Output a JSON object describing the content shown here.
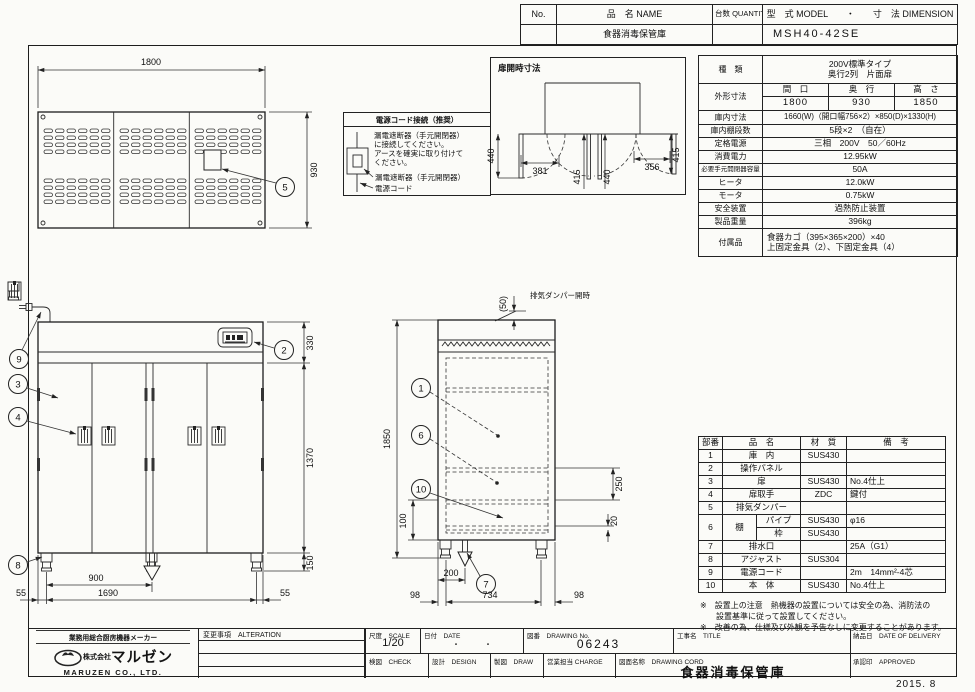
{
  "top_table": {
    "no_label": "No.",
    "name_label": "品　名 NAME",
    "qty_label": "台数 QUANTITY",
    "model_label": "型　式 MODEL　　・　　寸　法 DIMENSION",
    "product_name": "食器消毒保管庫",
    "model_value": "MSH40-42SE"
  },
  "spec": {
    "kind_label": "種　類",
    "kind1": "200V標準タイプ",
    "kind2": "奥行2列　片面扉",
    "outer_label": "外形寸法",
    "w_label": "間　口",
    "d_label": "奥　行",
    "h_label": "高　さ",
    "w_val": "1800",
    "d_val": "930",
    "h_val": "1850",
    "inner_label": "庫内寸法",
    "inner_val": "1660(W)（開口幅756×2）×850(D)×1330(H)",
    "shelf_label": "庫内棚段数",
    "shelf_val": "5段×2　（自在）",
    "power_label": "定格電源",
    "power_val": "三相　200V　50／60Hz",
    "cons_label": "消費電力",
    "cons_val": "12.95kW",
    "breaker_label": "必要手元開閉器容量",
    "breaker_val": "50A",
    "heater_label": "ヒータ",
    "heater_val": "12.0kW",
    "motor_label": "モータ",
    "motor_val": "0.75kW",
    "safety_label": "安全装置",
    "safety_val": "過熱防止装置",
    "weight_label": "製品重量",
    "weight_val": "396kg",
    "acc_label": "付属品",
    "acc1": "食器カゴ（395×365×200）×40",
    "acc2": "上固定金具（2）、下固定金具（4）"
  },
  "parts": {
    "h_no": "部番",
    "h_name": "品　名",
    "h_mat": "材　質",
    "h_note": "備　考",
    "rows_a": [
      {
        "no": "1",
        "name": "庫　内",
        "mat": "SUS430",
        "note": ""
      },
      {
        "no": "2",
        "name": "操作パネル",
        "mat": "",
        "note": ""
      },
      {
        "no": "3",
        "name": "扉",
        "mat": "SUS430",
        "note": "No.4仕上"
      },
      {
        "no": "4",
        "name": "扉取手",
        "mat": "ZDC",
        "note": "鍵付"
      },
      {
        "no": "5",
        "name": "排気ダンパー",
        "mat": "",
        "note": ""
      }
    ],
    "row6": {
      "no": "6",
      "name": "棚",
      "p1": "パイプ",
      "p1m": "SUS430",
      "p1n": "φ16",
      "p2": "枠",
      "p2m": "SUS430",
      "p2n": ""
    },
    "rows_b": [
      {
        "no": "7",
        "name": "排水口",
        "mat": "",
        "note": "25A（G1）"
      },
      {
        "no": "8",
        "name": "アジャスト",
        "mat": "SUS304",
        "note": ""
      },
      {
        "no": "9",
        "name": "電源コード",
        "mat": "",
        "note": "2m　14mm²-4芯"
      },
      {
        "no": "10",
        "name": "本　体",
        "mat": "SUS430",
        "note": "No.4仕上"
      }
    ],
    "note1": "※　設置上の注意　熱機器の設置については安全の為、消防法の",
    "note2": "設置基準に従って設置してください。",
    "note3": "※　改善の為、仕様及び外観を予告なしに変更することがあります。"
  },
  "power_box": {
    "title": "電源コード接続（推奨）",
    "l1": "漏電遮断器（手元開閉器）",
    "l2": "に接続してください。",
    "l3": "アースを確実に取り付けて",
    "l4": "ください。",
    "cap1": "漏電遮断器（手元開閉器）",
    "cap2": "電源コード"
  },
  "dooropen": {
    "title": "扉開時寸法",
    "d440a": "440",
    "d381": "381",
    "d415a": "415",
    "d440b": "440",
    "d356": "356",
    "d415b": "415"
  },
  "plan": {
    "d1800": "1800",
    "d930": "930",
    "c5": "5"
  },
  "front": {
    "d330": "330",
    "d1370": "1370",
    "d150": "150",
    "d900": "900",
    "d1690": "1690",
    "d55l": "55",
    "d55r": "55",
    "c9": "9",
    "c3": "3",
    "c4": "4",
    "c8": "8",
    "c2": "2"
  },
  "side": {
    "d1850": "1850",
    "d50": "(50)",
    "damper": "排気ダンパー開時",
    "d250": "250",
    "d20": "20",
    "d100": "100",
    "d200": "200",
    "d734": "734",
    "d98l": "98",
    "d98r": "98",
    "c1": "1",
    "c6": "6",
    "c10": "10",
    "c7": "7"
  },
  "footer": {
    "maker_tagline": "業務用総合厨房機器メーカー",
    "company_prefix": "株式会社",
    "company_name": "マルゼン",
    "company_en": "MARUZEN  CO., LTD.",
    "alteration_label": "変更事項　ALTERATION",
    "scale_label": "尺度　SCALE",
    "scale_value": "1/20",
    "date_label": "日付　DATE",
    "date_value": "・　　　・",
    "check_label": "検図　CHECK",
    "design_label": "設計　DESIGN",
    "draw_label": "製図　DRAW",
    "dwg_no_label": "図番　DRAWING No.",
    "dwg_no_value": "06243",
    "title_label": "工事名　TITLE",
    "charge_label": "営業担当 CHARGE",
    "dwg_name_label": "図面名称　DRAWING CORD",
    "dwg_name_value": "食器消毒保管庫",
    "delivery_label": "納品日　DATE OF DELIVERY",
    "approved_label": "承認印　APPROVED",
    "date_note": "2015. 8"
  }
}
